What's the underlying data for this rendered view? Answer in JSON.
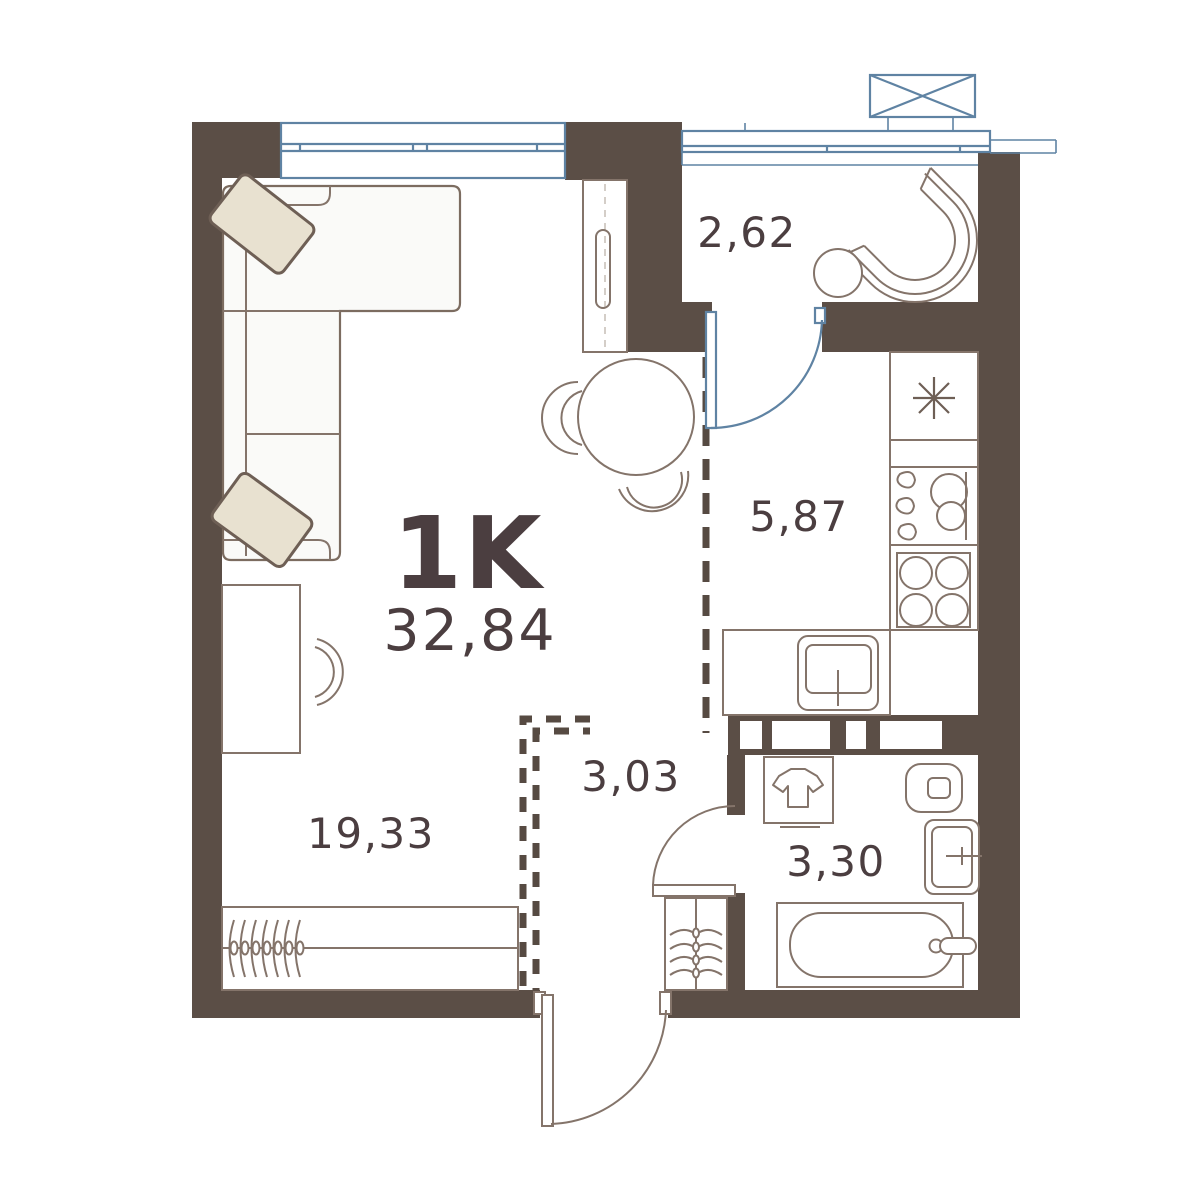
{
  "plan": {
    "unit": {
      "type_label": "1K",
      "total_area": "32,84"
    },
    "rooms": {
      "hallway": {
        "area": "2,62"
      },
      "kitchen": {
        "area": "5,87"
      },
      "corridor": {
        "area": "3,03"
      },
      "bathroom": {
        "area": "3,30"
      },
      "living": {
        "area": "19,33"
      }
    },
    "colors": {
      "wall": "#5b4e46",
      "text": "#4b3e40",
      "window_blue": "#5f83a3",
      "furniture_line": "#84746a",
      "pillow_fill": "#e8e1d0",
      "background": "#ffffff"
    }
  }
}
